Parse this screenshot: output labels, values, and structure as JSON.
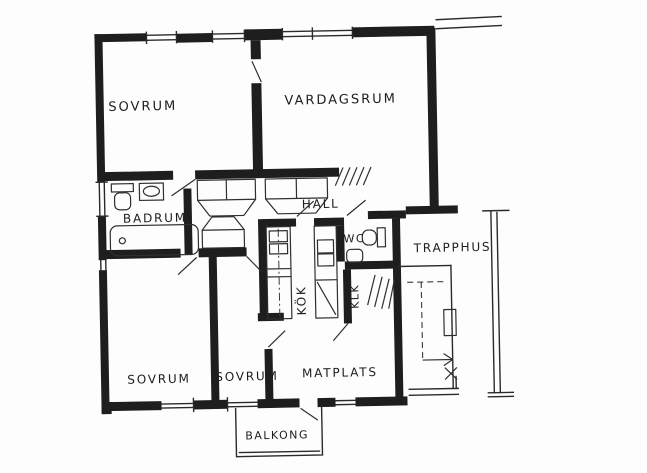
{
  "drawing": {
    "kind": "apartment floor plan (hand-drawn, scanned)",
    "ink_color": "#1e1e1e",
    "paper_color": "#fdfdfd",
    "rooms": {
      "sovrum_1": "SOVRUM",
      "vardagsrum": "VARDAGSRUM",
      "badrum": "BADRUM",
      "hall": "HALL",
      "wc": "WC",
      "trapphus": "TRAPPHUS",
      "kok": "KÖK",
      "klk": "KLK",
      "sovrum_2": "SOVRUM",
      "sovrum_3": "SOVRUM",
      "matplats": "MATPLATS",
      "balkong": "BALKONG"
    },
    "icons": {
      "bathtub-icon": "rounded rectangle with drain circle",
      "toilet-icon": "bowl with cistern rectangle",
      "sink-icon": "basin in rectangle",
      "wardrobe-icon": "rectangle with trapezoid front",
      "coat-rack-icon": "diagonal hatch lines",
      "clothes-rail-icon": "diagonal hatch lines",
      "kitchen-counter-icon": "counter strip with dash-dot line",
      "stove-icon": "stacked squares",
      "stairs-icon": "dashed run lines with direction arrow",
      "window-icon": "double parallel lines in wall opening",
      "door-swing-icon": "diagonal leaf line"
    }
  }
}
